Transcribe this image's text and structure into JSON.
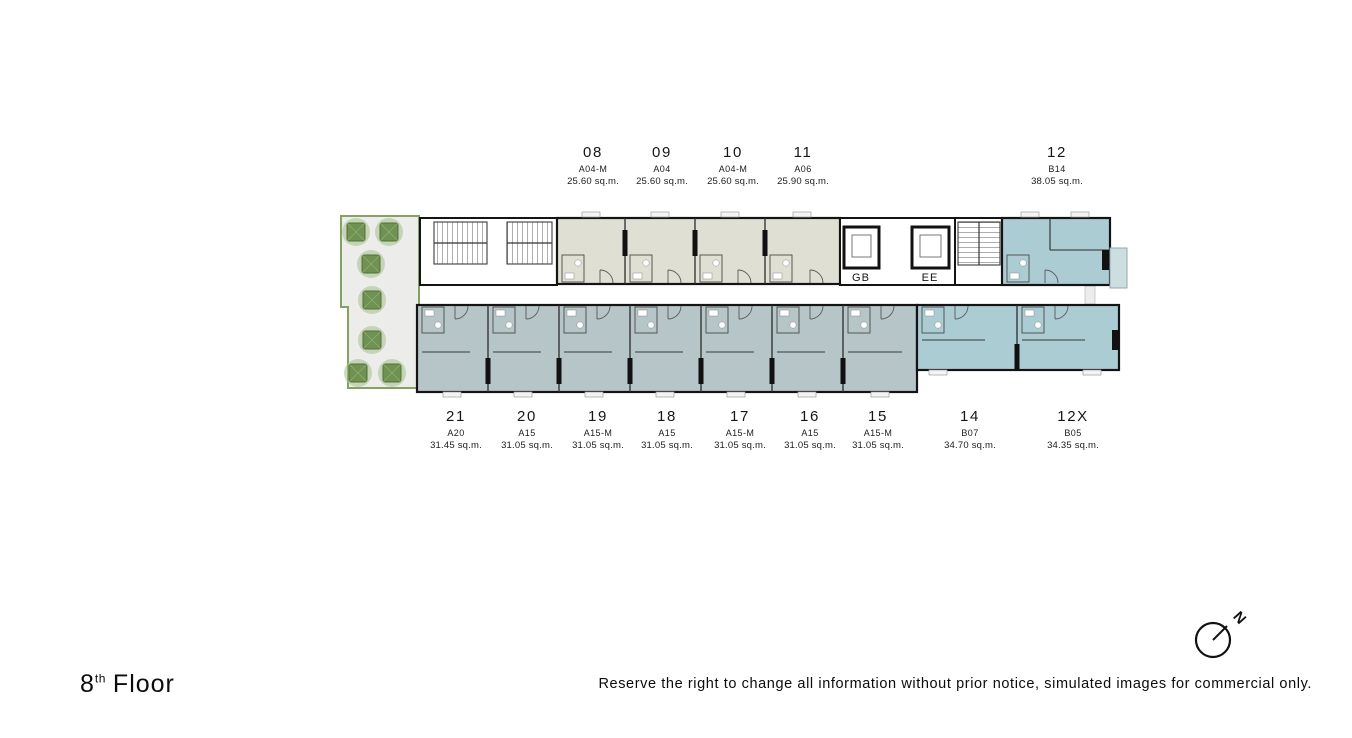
{
  "title": {
    "floor_number": "8",
    "floor_suffix": "th",
    "floor_word": "Floor"
  },
  "disclaimer": "Reserve the right to change all information without prior notice, simulated images for commercial only.",
  "compass": {
    "label": "N"
  },
  "cores": {
    "gb_label": "GB",
    "ee_label": "EE"
  },
  "units_top": [
    {
      "no": "08",
      "type": "A04-M",
      "area": "25.60 sq.m."
    },
    {
      "no": "09",
      "type": "A04",
      "area": "25.60 sq.m."
    },
    {
      "no": "10",
      "type": "A04-M",
      "area": "25.60 sq.m."
    },
    {
      "no": "11",
      "type": "A06",
      "area": "25.90 sq.m."
    },
    {
      "no": "12",
      "type": "B14",
      "area": "38.05 sq.m."
    }
  ],
  "units_bottom": [
    {
      "no": "21",
      "type": "A20",
      "area": "31.45 sq.m."
    },
    {
      "no": "20",
      "type": "A15",
      "area": "31.05 sq.m."
    },
    {
      "no": "19",
      "type": "A15-M",
      "area": "31.05 sq.m."
    },
    {
      "no": "18",
      "type": "A15",
      "area": "31.05 sq.m."
    },
    {
      "no": "17",
      "type": "A15-M",
      "area": "31.05 sq.m."
    },
    {
      "no": "16",
      "type": "A15",
      "area": "31.05 sq.m."
    },
    {
      "no": "15",
      "type": "A15-M",
      "area": "31.05 sq.m."
    },
    {
      "no": "14",
      "type": "B07",
      "area": "34.70 sq.m."
    },
    {
      "no": "12X",
      "type": "B05",
      "area": "34.35 sq.m."
    }
  ],
  "colors": {
    "wall": "#141414",
    "unit_top_fill": "#dfe0d3",
    "unit_left_fill": "#b6c5c7",
    "unit_right_fill": "#abccd2",
    "balcony_fill": "#cddee1",
    "garden_fill": "#ececea",
    "garden_border": "#84a263",
    "tree_fill": "#6f9151",
    "tree_halo": "#a6bf8c",
    "tree_stroke": "#50703a"
  }
}
